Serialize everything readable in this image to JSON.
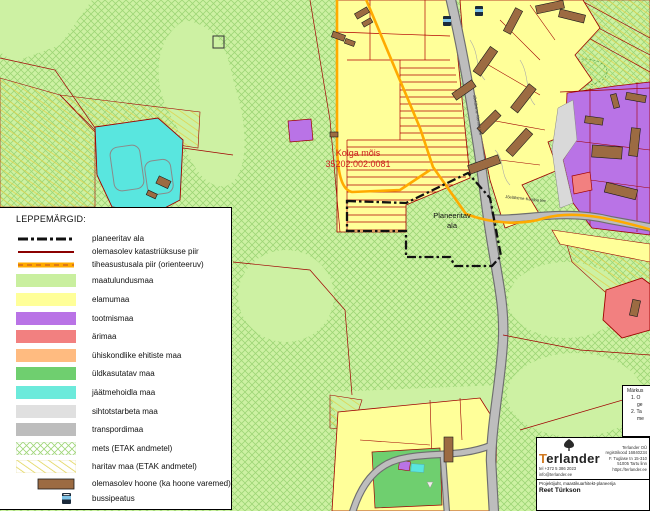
{
  "map": {
    "labels": {
      "estate_name": "Kolga mõis",
      "estate_cadastral": "35202:002:0081",
      "planned_area_line1": "Planeeritav",
      "planned_area_line2": "ala",
      "road_name": "Jõelähtme-Kemba tee"
    },
    "colors": {
      "background": "#cdf1a3",
      "forest_hatch": "#9ed677",
      "field_hatch": "#e0d24c",
      "road_fill": "#bdbdbd",
      "road_casing": "#6e6e6e",
      "cadastral_line": "#a00000",
      "strip_line": "#b30000",
      "orange_boundary": "#ffaa00",
      "planned_boundary": "#111111",
      "building": "#9c6b42",
      "estate_label": "#cc2020"
    }
  },
  "legend": {
    "title": "LEPPEMÄRGID:",
    "items": [
      {
        "label": "planeeritav ala",
        "symbol": "dash-dot-line",
        "color": "#111111"
      },
      {
        "label": "olemasolev katastriüksuse piir",
        "symbol": "solid-line",
        "color": "#8b0000"
      },
      {
        "label": "tiheasustusala piir (orienteeruv)",
        "symbol": "orange-dashed-line",
        "color": "#ffaa00"
      },
      {
        "label": "maatulundusmaa",
        "symbol": "swatch",
        "color": "#c9ef9f"
      },
      {
        "label": "elamumaa",
        "symbol": "swatch",
        "color": "#ffff99"
      },
      {
        "label": "tootmismaa",
        "symbol": "swatch",
        "color": "#b973e6"
      },
      {
        "label": "ärimaa",
        "symbol": "swatch",
        "color": "#f28080"
      },
      {
        "label": "ühiskondlike ehitiste maa",
        "symbol": "swatch",
        "color": "#ffbb80"
      },
      {
        "label": "üldkasutatav maa",
        "symbol": "swatch",
        "color": "#6fcf6f"
      },
      {
        "label": "jäätmehoidla maa",
        "symbol": "swatch",
        "color": "#6ceadb"
      },
      {
        "label": "sihtotstarbeta maa",
        "symbol": "swatch",
        "color": "#e0e0e0"
      },
      {
        "label": "transpordimaa",
        "symbol": "swatch",
        "color": "#bdbdbd"
      },
      {
        "label": "mets (ETAK andmetel)",
        "symbol": "crosshatch-swatch",
        "color": "#9ed677"
      },
      {
        "label": "haritav maa (ETAK andmetel)",
        "symbol": "diagonal-hatch-swatch",
        "color": "#e0d24c"
      },
      {
        "label": "olemasolev hoone (ka hoone varemed)",
        "symbol": "building-swatch",
        "color": "#9c6b42"
      },
      {
        "label": "bussipeatus",
        "symbol": "bus-stop-icon",
        "color": "#1b2a3a"
      }
    ]
  },
  "notes": {
    "title": "Märkus",
    "lines": [
      "1. O",
      "ge",
      "2. Ta",
      "me"
    ]
  },
  "title_block": {
    "company": "erlander",
    "company_initial": "T",
    "phone": "tel +372 5 386 2023",
    "email": "info@terlander.ee",
    "company_full": "Terlander OÜ",
    "reg_code": "registrikood 16840234",
    "address1": "F. Tuglase tn 15-310",
    "address2": "51005 Tartu linn",
    "website": "https://terlander.ee",
    "role": "Projektijuht, maastikuarhitekt-planeerija",
    "person": "Reet Türkson"
  }
}
